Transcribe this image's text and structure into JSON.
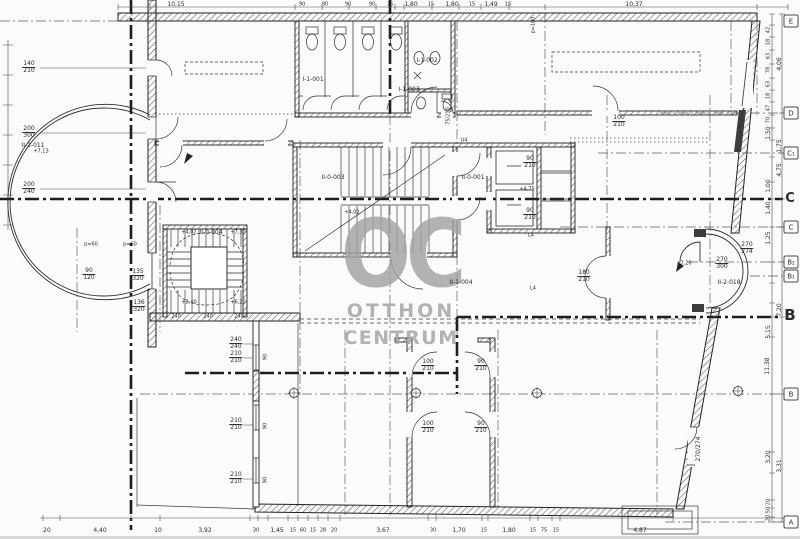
{
  "colors": {
    "ink": "#2b2b2b",
    "watermark": "#a3a3a3",
    "paper": "#fbfbfb"
  },
  "watermark": {
    "oc": "OC",
    "line2": "OTTHON",
    "line3": "CENTRUM"
  },
  "grid_bubbles": [
    {
      "t": "E",
      "x": 791,
      "y": 21
    },
    {
      "t": "D",
      "x": 791,
      "y": 113
    },
    {
      "t": "C₁",
      "x": 791,
      "y": 153
    },
    {
      "t": "C",
      "x": 791,
      "y": 227
    },
    {
      "t": "B₂",
      "x": 791,
      "y": 262
    },
    {
      "t": "B₁",
      "x": 791,
      "y": 276
    },
    {
      "t": "B",
      "x": 791,
      "y": 394
    },
    {
      "t": "A",
      "x": 791,
      "y": 522
    }
  ],
  "labels": [
    {
      "t": "II-1-011",
      "x": 33,
      "y": 146,
      "s": 6,
      "n": "room-label-II-1-011"
    },
    {
      "t": "I-1-001",
      "x": 313,
      "y": 80,
      "s": 6,
      "n": "room-label-I-1-001"
    },
    {
      "t": "I-1-002",
      "x": 427,
      "y": 61,
      "s": 6,
      "n": "room-label-I-1-002"
    },
    {
      "t": "I-1-003",
      "x": 409,
      "y": 90,
      "s": 6,
      "n": "room-label-I-1-003"
    },
    {
      "t": "II-0-003",
      "x": 333,
      "y": 178,
      "s": 6,
      "n": "room-label-II-0-003"
    },
    {
      "t": "II-0-001",
      "x": 473,
      "y": 178,
      "s": 6,
      "n": "room-label-II-0-001"
    },
    {
      "t": "II-0-004",
      "x": 211,
      "y": 233,
      "s": 6,
      "n": "room-label-II-0-004"
    },
    {
      "t": "II-1-004",
      "x": 461,
      "y": 283,
      "s": 6,
      "n": "room-label-II-1-004"
    },
    {
      "t": "II-2-018",
      "x": 729,
      "y": 283,
      "s": 6,
      "n": "room-label-II-2-018"
    },
    {
      "t": "140",
      "b": "210",
      "x": 29,
      "y": 68
    },
    {
      "t": "200",
      "b": "300",
      "x": 29,
      "y": 133
    },
    {
      "t": "200",
      "b": "240",
      "x": 29,
      "y": 189
    },
    {
      "t": "90",
      "b": "120",
      "x": 89,
      "y": 275
    },
    {
      "t": "135",
      "b": "320",
      "x": 138,
      "y": 276
    },
    {
      "t": "136",
      "b": "320",
      "x": 139,
      "y": 307
    },
    {
      "t": "240",
      "b": "240",
      "x": 236,
      "y": 344
    },
    {
      "t": "210",
      "b": "210",
      "x": 236,
      "y": 358
    },
    {
      "t": "210",
      "b": "210",
      "x": 236,
      "y": 425
    },
    {
      "t": "210",
      "b": "210",
      "x": 236,
      "y": 479
    },
    {
      "t": "90",
      "x": 266,
      "y": 357,
      "r": -90,
      "s": 5
    },
    {
      "t": "90",
      "x": 266,
      "y": 426,
      "r": -90,
      "s": 5
    },
    {
      "t": "90",
      "x": 266,
      "y": 480,
      "r": -90,
      "s": 5
    },
    {
      "t": "100",
      "b": "210",
      "x": 428,
      "y": 366
    },
    {
      "t": "90",
      "b": "210",
      "x": 481,
      "y": 366
    },
    {
      "t": "100",
      "b": "210",
      "x": 428,
      "y": 428
    },
    {
      "t": "90",
      "b": "210",
      "x": 481,
      "y": 428
    },
    {
      "t": "100",
      "b": "210",
      "x": 619,
      "y": 122
    },
    {
      "t": "180",
      "b": "210",
      "x": 584,
      "y": 277
    },
    {
      "t": "90",
      "b": "210",
      "x": 530,
      "y": 163
    },
    {
      "t": "90",
      "b": "210",
      "x": 530,
      "y": 215
    },
    {
      "t": "270",
      "b": "300",
      "x": 722,
      "y": 264
    },
    {
      "t": "270",
      "b": "274",
      "x": 747,
      "y": 249
    },
    {
      "t": "270/274",
      "x": 699,
      "y": 449,
      "r": -90
    },
    {
      "t": "75/210",
      "x": 449,
      "y": 116,
      "r": -90,
      "s": 5
    },
    {
      "t": "p=60",
      "x": 91,
      "y": 245,
      "s": 5
    },
    {
      "t": "p=60",
      "x": 130,
      "y": 245,
      "s": 5
    },
    {
      "t": "p=100",
      "x": 534,
      "y": 25,
      "r": -90,
      "s": 5
    },
    {
      "t": "+7,13",
      "x": 41,
      "y": 152,
      "s": 5
    },
    {
      "t": "+4,02",
      "x": 352,
      "y": 213,
      "s": 5
    },
    {
      "t": "+4,75",
      "x": 527,
      "y": 190,
      "s": 5
    },
    {
      "t": "+7,20",
      "x": 684,
      "y": 264,
      "s": 5
    },
    {
      "t": "+4,02",
      "x": 189,
      "y": 233,
      "s": 5
    },
    {
      "t": "+7,30",
      "x": 238,
      "y": 233,
      "s": 5
    },
    {
      "t": "+5,40",
      "x": 189,
      "y": 303,
      "s": 5
    },
    {
      "t": "+6,20",
      "x": 238,
      "y": 303,
      "s": 5
    },
    {
      "t": "240",
      "x": 176,
      "y": 317,
      "s": 5
    },
    {
      "t": "240",
      "x": 208,
      "y": 317,
      "s": 5
    },
    {
      "t": "240",
      "x": 239,
      "y": 317,
      "s": 5
    },
    {
      "t": "U4",
      "x": 464,
      "y": 141,
      "s": 5
    },
    {
      "t": "L4",
      "x": 531,
      "y": 236,
      "s": 5
    },
    {
      "t": "L4",
      "x": 533,
      "y": 289,
      "s": 5
    },
    {
      "t": "10,15",
      "x": 176,
      "y": 5,
      "s": 6
    },
    {
      "t": "90",
      "x": 302,
      "y": 5,
      "s": 5
    },
    {
      "t": "90",
      "x": 325,
      "y": 5,
      "s": 5
    },
    {
      "t": "90",
      "x": 348,
      "y": 5,
      "s": 5
    },
    {
      "t": "90",
      "x": 372,
      "y": 5,
      "s": 5
    },
    {
      "t": "15",
      "x": 390,
      "y": 5,
      "s": 5
    },
    {
      "t": "1,80",
      "x": 411,
      "y": 5,
      "s": 6
    },
    {
      "t": "15",
      "x": 431,
      "y": 5,
      "s": 5
    },
    {
      "t": "1,80",
      "x": 452,
      "y": 5,
      "s": 6
    },
    {
      "t": "15",
      "x": 472,
      "y": 5,
      "s": 5
    },
    {
      "t": "1,49",
      "x": 491,
      "y": 5,
      "s": 6
    },
    {
      "t": "15",
      "x": 508,
      "y": 5,
      "s": 5
    },
    {
      "t": "10,37",
      "x": 634,
      "y": 5,
      "s": 6
    },
    {
      "t": "20",
      "x": 47,
      "y": 531,
      "s": 6
    },
    {
      "t": "4,40",
      "x": 100,
      "y": 531,
      "s": 6
    },
    {
      "t": "10",
      "x": 158,
      "y": 531,
      "s": 6
    },
    {
      "t": "3,92",
      "x": 205,
      "y": 531,
      "s": 6
    },
    {
      "t": "30",
      "x": 256,
      "y": 531,
      "s": 5
    },
    {
      "t": "1,45",
      "x": 277,
      "y": 531,
      "s": 6
    },
    {
      "t": "15",
      "x": 293,
      "y": 531,
      "s": 5
    },
    {
      "t": "60",
      "x": 303,
      "y": 531,
      "s": 5
    },
    {
      "t": "15",
      "x": 313,
      "y": 531,
      "s": 5
    },
    {
      "t": "28",
      "x": 323,
      "y": 531,
      "s": 5
    },
    {
      "t": "20",
      "x": 334,
      "y": 531,
      "s": 5
    },
    {
      "t": "3,67",
      "x": 383,
      "y": 531,
      "s": 6
    },
    {
      "t": "30",
      "x": 433,
      "y": 531,
      "s": 5
    },
    {
      "t": "1,70",
      "x": 459,
      "y": 531,
      "s": 6
    },
    {
      "t": "15",
      "x": 484,
      "y": 531,
      "s": 5
    },
    {
      "t": "1,80",
      "x": 509,
      "y": 531,
      "s": 6
    },
    {
      "t": "15",
      "x": 533,
      "y": 531,
      "s": 5
    },
    {
      "t": "75",
      "x": 544,
      "y": 531,
      "s": 5
    },
    {
      "t": "15",
      "x": 556,
      "y": 531,
      "s": 5
    },
    {
      "t": "4,87",
      "x": 640,
      "y": 531,
      "s": 6
    },
    {
      "t": "42",
      "x": 769,
      "y": 30,
      "r": -90,
      "s": 5
    },
    {
      "t": "18",
      "x": 769,
      "y": 42,
      "r": -90,
      "s": 5
    },
    {
      "t": "63",
      "x": 769,
      "y": 56,
      "r": -90,
      "s": 5
    },
    {
      "t": "78",
      "x": 769,
      "y": 70,
      "r": -90,
      "s": 5
    },
    {
      "t": "63",
      "x": 769,
      "y": 84,
      "r": -90,
      "s": 5
    },
    {
      "t": "18",
      "x": 769,
      "y": 96,
      "r": -90,
      "s": 5
    },
    {
      "t": "47",
      "x": 769,
      "y": 108,
      "r": -90,
      "s": 5
    },
    {
      "t": "70",
      "x": 769,
      "y": 120,
      "r": -90,
      "s": 5
    },
    {
      "t": "4,06",
      "x": 780,
      "y": 64,
      "r": -90,
      "s": 6
    },
    {
      "t": "1,50",
      "x": 769,
      "y": 133,
      "r": -90,
      "s": 6
    },
    {
      "t": "1,75",
      "x": 780,
      "y": 146,
      "r": -90,
      "s": 6
    },
    {
      "t": "4,75",
      "x": 780,
      "y": 170,
      "r": -90,
      "s": 6
    },
    {
      "t": "1,00",
      "x": 769,
      "y": 186,
      "r": -90,
      "s": 6
    },
    {
      "t": "1,40",
      "x": 769,
      "y": 208,
      "r": -90,
      "s": 6
    },
    {
      "t": "1,25",
      "x": 769,
      "y": 238,
      "r": -90,
      "s": 6
    },
    {
      "t": "7,20",
      "x": 780,
      "y": 310,
      "r": -90,
      "s": 6
    },
    {
      "t": "5,15",
      "x": 769,
      "y": 332,
      "r": -90,
      "s": 6
    },
    {
      "t": "11,38",
      "x": 768,
      "y": 366,
      "r": -90,
      "s": 6
    },
    {
      "t": "3,20",
      "x": 769,
      "y": 457,
      "r": -90,
      "s": 6
    },
    {
      "t": "3,31",
      "x": 780,
      "y": 466,
      "r": -90,
      "s": 6
    },
    {
      "t": "20",
      "x": 769,
      "y": 502,
      "r": -90,
      "s": 5
    },
    {
      "t": "50",
      "x": 769,
      "y": 510,
      "r": -90,
      "s": 5
    },
    {
      "t": "20",
      "x": 769,
      "y": 518,
      "r": -90,
      "s": 5
    },
    {
      "t": "C",
      "x": 790,
      "y": 199,
      "s": 13,
      "cls": "big",
      "n": "section-letter-C"
    },
    {
      "t": "B",
      "x": 790,
      "y": 315,
      "s": 15,
      "cls": "big",
      "n": "section-letter-B"
    }
  ]
}
